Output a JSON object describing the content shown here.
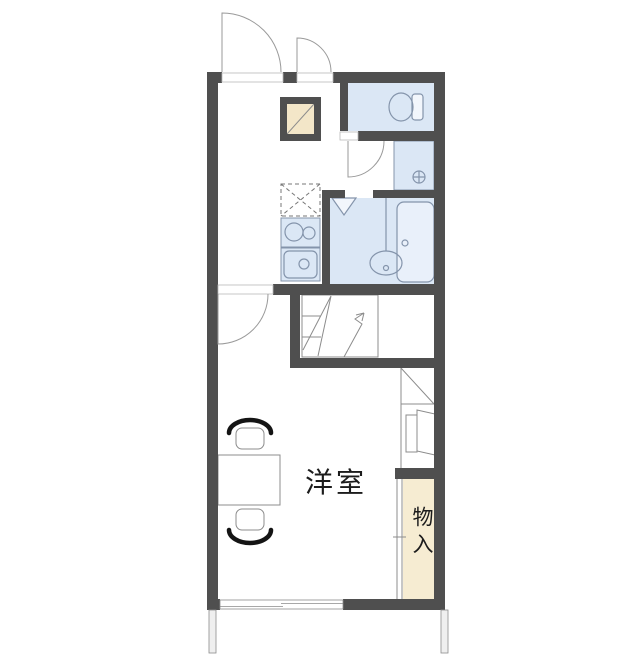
{
  "labels": {
    "main_room": "洋室",
    "storage": "物入"
  },
  "colors": {
    "wall": "#4f4f4f",
    "wet_area": "#dbe7f5",
    "tub": "#e9f0fa",
    "storage": "#f6ecd2",
    "cabinet": "#f3e6c8",
    "fixture_line": "#8494ab",
    "thin_line": "#8c8c8c",
    "chair_arc": "#141414",
    "text": "#1c1c1c"
  },
  "fixtures": [
    "entrance-door",
    "small-closet-door",
    "toilet",
    "washing-machine-pan",
    "unit-bath",
    "bathtub",
    "washbasin",
    "bath-folding-door",
    "refrigerator-space",
    "gas-stove",
    "kitchen-sink",
    "pipe-space",
    "staircase-to-loft",
    "under-stair-counter",
    "appliance-space",
    "storage-closet",
    "sliding-window",
    "table",
    "chair"
  ]
}
